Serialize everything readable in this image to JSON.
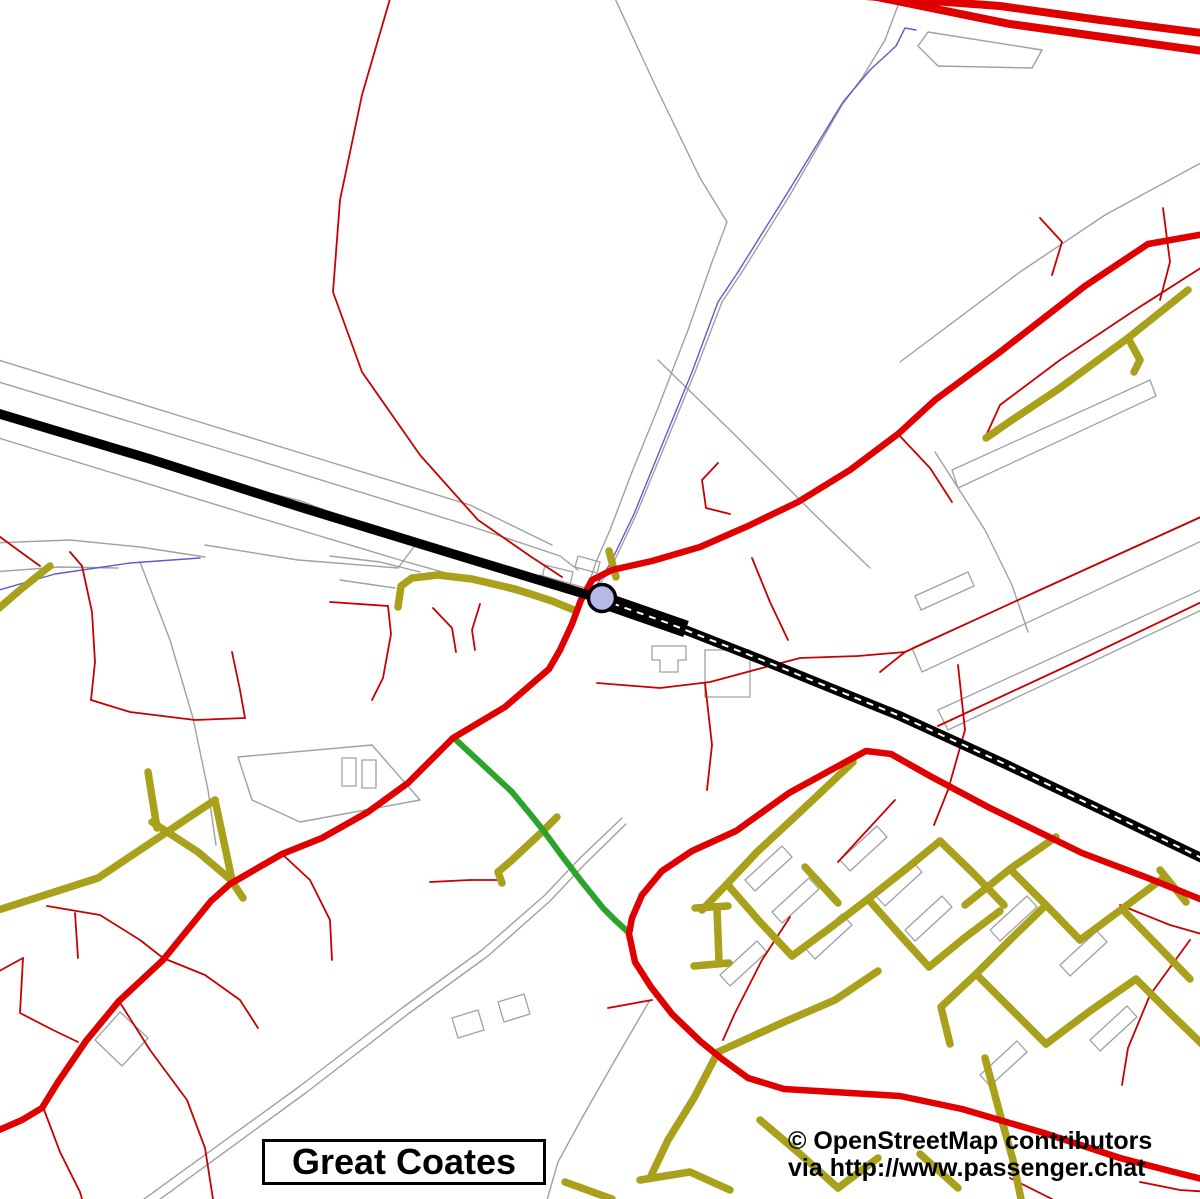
{
  "map": {
    "place_label": "Great Coates",
    "attribution": {
      "line1": "© OpenStreetMap contributors",
      "line2": "via http://www.passenger.chat"
    },
    "station": {
      "kind": "railway-station-marker",
      "marker_fill": "#b8b8e8",
      "marker_outline": "#000000"
    },
    "colors": {
      "background": "#ffffff",
      "railway": "#000000",
      "railway_dash": "#ffffff",
      "trunk_road": "#e00000",
      "primary_road": "#e00000",
      "minor_road": "#c80000",
      "residential_road": "#a9a11b",
      "footpath": "#2da32d",
      "water": "#5c5ccc",
      "boundary": "#a0a0a0",
      "label_text": "#000000"
    }
  }
}
